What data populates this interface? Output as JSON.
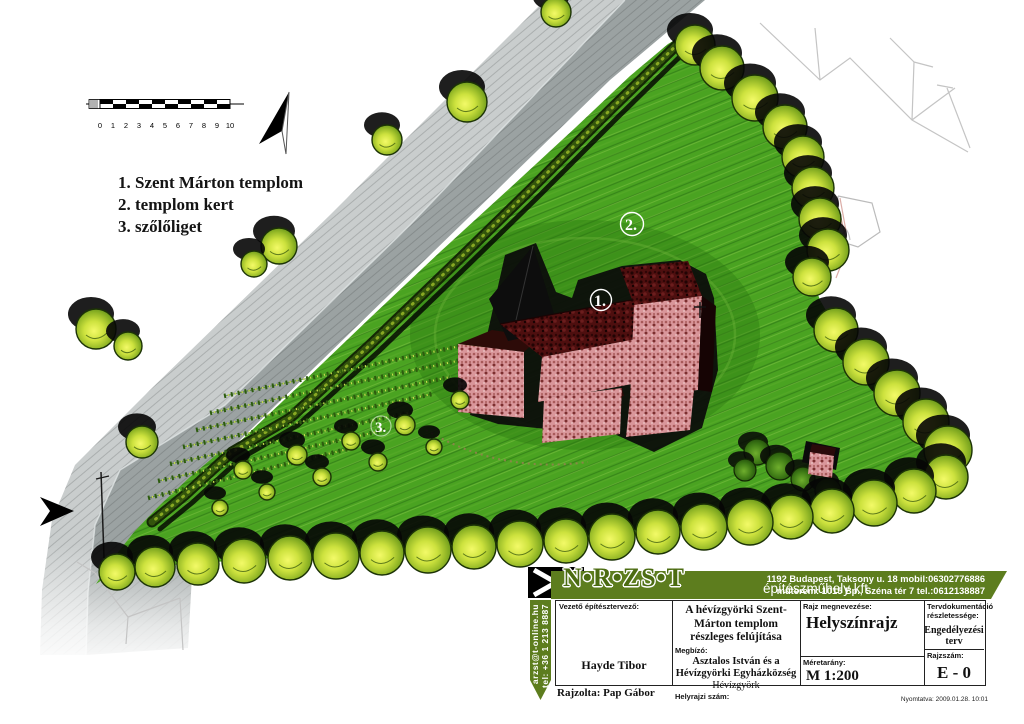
{
  "colors": {
    "banner_green": "#5d7d1e",
    "grass": "#4aa321",
    "roof_red": "#4e0f0f",
    "wall_pink": "#d9969a",
    "road_gray": "#9ba2a2"
  },
  "scalebar": {
    "labels": [
      "0",
      "1",
      "2",
      "3",
      "4",
      "5",
      "6",
      "7",
      "8",
      "9",
      "10"
    ]
  },
  "legend": {
    "items": [
      "1. Szent Márton templom",
      "2. templom kert",
      "3. szőlőliget"
    ]
  },
  "plan": {
    "labels": [
      "1.",
      "2.",
      "3."
    ],
    "trees": [
      [
        695,
        45,
        20
      ],
      [
        722,
        68,
        22
      ],
      [
        755,
        98,
        23
      ],
      [
        785,
        127,
        22
      ],
      [
        803,
        157,
        21
      ],
      [
        813,
        188,
        21
      ],
      [
        820,
        219,
        21
      ],
      [
        828,
        250,
        21
      ],
      [
        812,
        277,
        19
      ],
      [
        836,
        330,
        22
      ],
      [
        866,
        362,
        23
      ],
      [
        897,
        393,
        23
      ],
      [
        926,
        422,
        23
      ],
      [
        948,
        450,
        24
      ],
      [
        946,
        477,
        22
      ],
      [
        914,
        491,
        22
      ],
      [
        874,
        503,
        23
      ],
      [
        832,
        511,
        22
      ],
      [
        791,
        517,
        22
      ],
      [
        750,
        522,
        23
      ],
      [
        704,
        527,
        23
      ],
      [
        658,
        532,
        22
      ],
      [
        612,
        537,
        23
      ],
      [
        566,
        541,
        22
      ],
      [
        520,
        544,
        23
      ],
      [
        474,
        547,
        22
      ],
      [
        428,
        550,
        23
      ],
      [
        382,
        553,
        22
      ],
      [
        336,
        556,
        23
      ],
      [
        290,
        558,
        22
      ],
      [
        244,
        561,
        22
      ],
      [
        198,
        564,
        21
      ],
      [
        155,
        567,
        20
      ],
      [
        117,
        572,
        18
      ],
      [
        467,
        102,
        20
      ],
      [
        387,
        140,
        15
      ],
      [
        279,
        246,
        18
      ],
      [
        254,
        264,
        13
      ],
      [
        96,
        329,
        20
      ],
      [
        128,
        346,
        14
      ],
      [
        142,
        442,
        16
      ],
      [
        556,
        12,
        15
      ],
      [
        243,
        470,
        9
      ],
      [
        297,
        455,
        10
      ],
      [
        351,
        441,
        9
      ],
      [
        405,
        425,
        10
      ],
      [
        267,
        492,
        8
      ],
      [
        322,
        477,
        9
      ],
      [
        378,
        462,
        9
      ],
      [
        434,
        447,
        8
      ],
      [
        460,
        400,
        9
      ],
      [
        220,
        508,
        8
      ]
    ],
    "bushes": [
      [
        757,
        452,
        13
      ],
      [
        780,
        466,
        14
      ],
      [
        803,
        479,
        12
      ],
      [
        828,
        491,
        13
      ],
      [
        745,
        470,
        11
      ]
    ],
    "vine_rows": [
      [
        148,
        498,
        352,
        448
      ],
      [
        158,
        481,
        385,
        430
      ],
      [
        170,
        464,
        412,
        412
      ],
      [
        183,
        447,
        432,
        394
      ],
      [
        196,
        430,
        450,
        377
      ],
      [
        210,
        413,
        462,
        360
      ],
      [
        224,
        396,
        470,
        344
      ]
    ]
  },
  "titleblock": {
    "logo_text": "N•R•ZS•T",
    "company": "építészműhely kft",
    "address_line1": "1192 Budapest, Taksony u. 18  mobil:06302776886",
    "address_line2": "műterem: 1015 Bp., Széna tér 7 tel.:0612138887",
    "ribbon_line1": "arzst@t-online.hu",
    "ribbon_line2": "tel: +36 1 213 8887",
    "lead_architect_label": "Vezető építésztervező:",
    "lead_architect": "Hayde Tibor",
    "project_title": "A hévízgyörki Szent-Márton templom részleges felújítása",
    "client_label": "Megbízó:",
    "client_name": "Asztalos István és a Hévízgyörki Egyházközség",
    "client_place": "Hévízgyörk",
    "parcel_label": "Helyrajzi szám:",
    "drawing_name_label": "Rajz megnevezése:",
    "drawing_name": "Helyszínrajz",
    "scale_label": "Méretarány:",
    "scale": "M 1:200",
    "doc_detail_label": "Tervdokumentáció részletessége:",
    "doc_detail": "Engedélyezési terv",
    "drawing_no_label": "Rajzszám:",
    "drawing_no": "E - 0",
    "drawn_by": "Rajzolta: Pap Gábor",
    "printed": "Nyomtatva: 2009.01.28. 10:01"
  }
}
